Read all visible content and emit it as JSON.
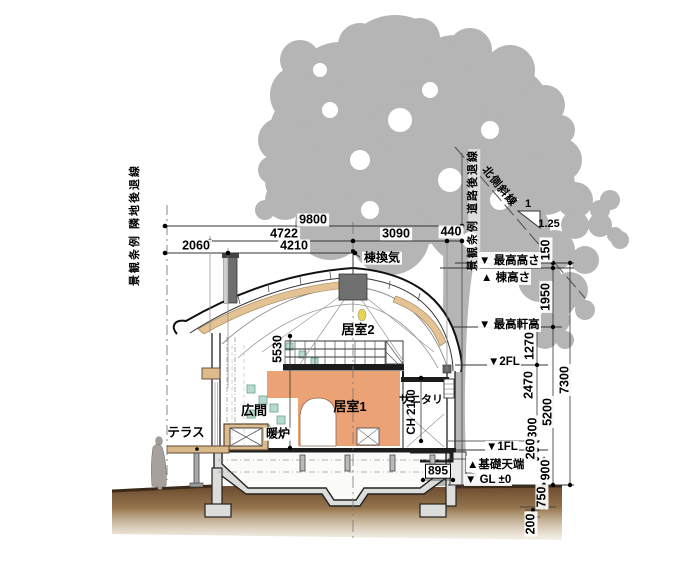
{
  "drawing": {
    "type": "architectural-section",
    "rooms": {
      "loft": "居室2",
      "living": "居室1",
      "hall": "広間",
      "fireplace": "暖炉",
      "sanitary": "サニタリ",
      "terrace": "テラス"
    },
    "roof": {
      "ridge_vent": "棟換気"
    },
    "levels": {
      "max_height": "▼ 最高高さ",
      "ridge_height": "▲ 棟高さ",
      "max_eave": "▼ 最高軒高",
      "fl2": "▼2FL",
      "fl1": "▼1FL",
      "foundation_top": "▲基礎天端",
      "gl": "▼ GL ±0"
    },
    "dims": {
      "top": [
        "9800",
        "4722",
        "3090",
        "440",
        "2060",
        "4210"
      ],
      "right": [
        "150",
        "1950",
        "1270",
        "7300",
        "2470",
        "5200",
        "300",
        "260",
        "900",
        "750",
        "200"
      ],
      "inner": {
        "loft_height": "5530",
        "entry": "895",
        "ceiling": "CH 2100"
      }
    },
    "site": {
      "left_setback": "景観条例 隣地後退線",
      "right_setback": "景観条例 道路後退線",
      "north_slope": "北側斜線",
      "slope_rise": "1",
      "slope_run": "1.25"
    },
    "colors": {
      "tree": "#b5b5b5",
      "wall_finish": "#eba275",
      "wood": "#e3c393",
      "tile": "#b7dccd",
      "soil_dark": "#6b4a2e",
      "soil_light": "#cdb894",
      "concrete": "#e4e4e2",
      "vent_gray": "#6e6e6e"
    }
  }
}
